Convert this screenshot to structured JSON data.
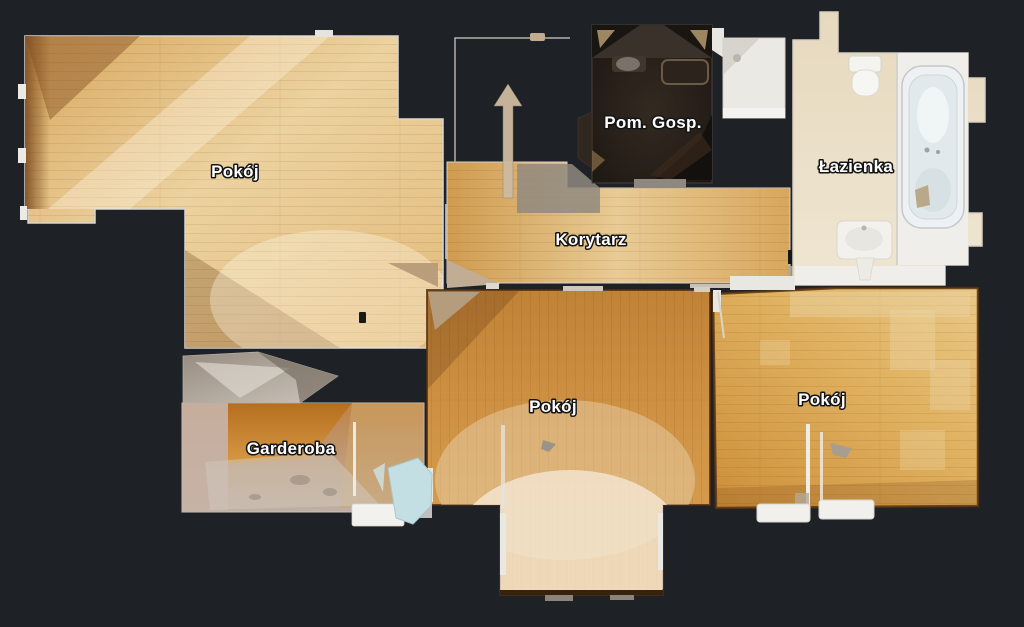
{
  "app": {
    "name": "apartment-floorplan-view",
    "background_color": "#1e2126"
  },
  "floorplan": {
    "labels": [
      {
        "room": "pokoj-nw",
        "text": "Pokój"
      },
      {
        "room": "pom-gosp",
        "text": "Pom. Gosp."
      },
      {
        "room": "lazienka",
        "text": "Łazienka"
      },
      {
        "room": "korytarz",
        "text": "Korytarz"
      },
      {
        "room": "pokoj-center",
        "text": "Pokój"
      },
      {
        "room": "garderoba",
        "text": "Garderoba"
      },
      {
        "room": "pokoj-east",
        "text": "Pokój"
      }
    ],
    "colors": {
      "background": "#1e2126",
      "label_text": "#ffffff",
      "label_outline": "#141414",
      "wood_pale": "#ecd2a0",
      "wood_amber": "#cf9244",
      "wood_gold": "#e0b261",
      "bathroom_tile": "#eadec6",
      "dark_utility_floor": "#251e18",
      "wall_white": "#e9e6e0",
      "door_blue": "#c3dfe4",
      "metal_gray": "#b7a58c"
    },
    "icons": [
      {
        "name": "entrance-arrow-icon",
        "glyph": "↑"
      }
    ],
    "fixtures": [
      "bathtub",
      "toilet",
      "sink",
      "shower",
      "radiator",
      "wardrobe-top",
      "open-door"
    ]
  }
}
